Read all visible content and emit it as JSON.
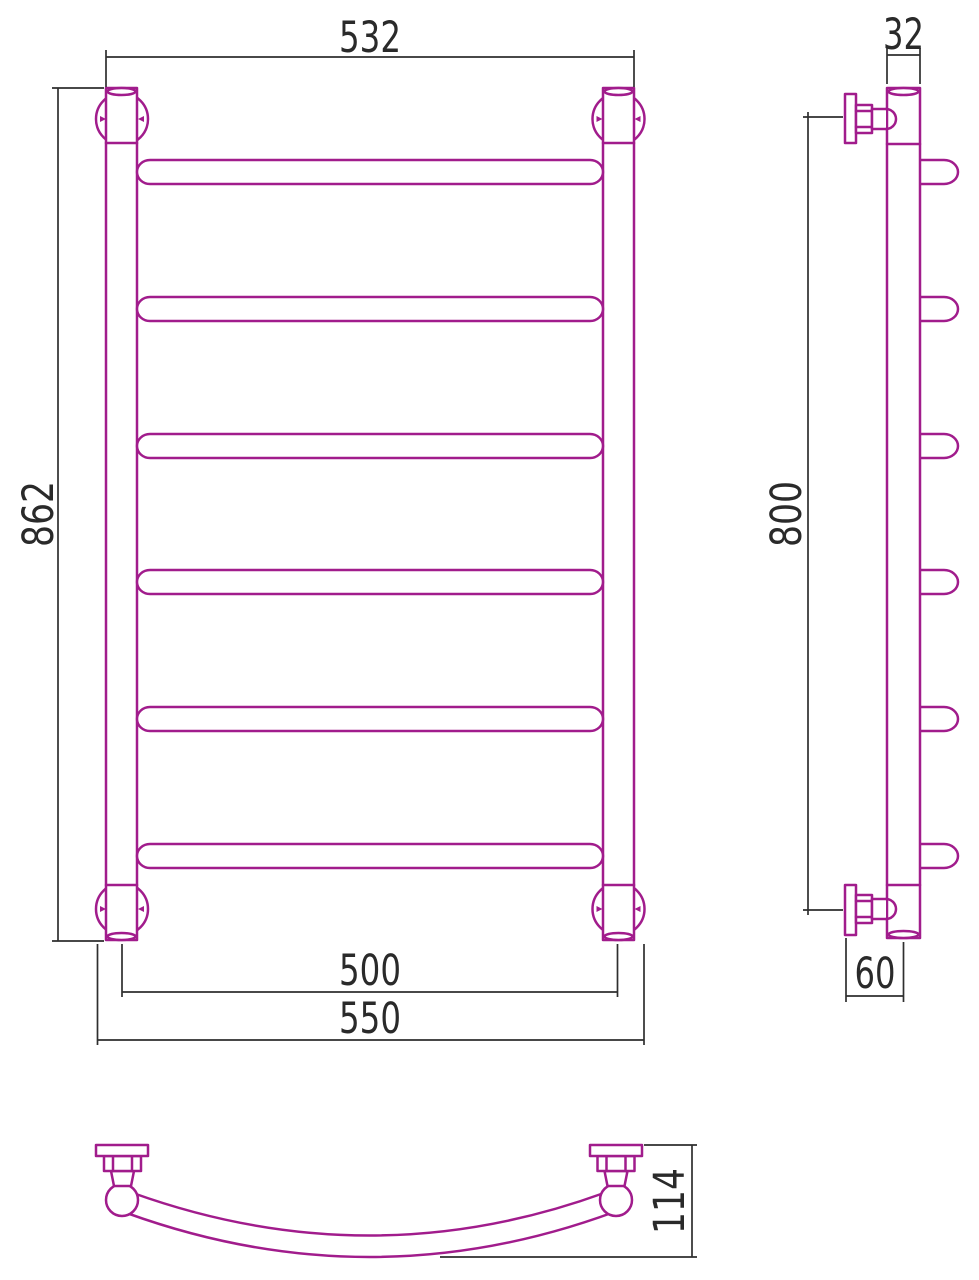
{
  "drawing_type": "towel-rail technical drawing, three orthographic views",
  "colors": {
    "outline": "#A11C8C",
    "dimension": "#2F2F2F",
    "background": "#FFFFFF"
  },
  "dimensions": {
    "front": {
      "top_width": "532",
      "height": "862",
      "axis_width": "500",
      "overall_width": "550"
    },
    "side": {
      "pipe_diameter": "32",
      "mount_spacing": "800",
      "wall_offset": "60"
    },
    "bottom": {
      "arc_depth": "114"
    }
  }
}
